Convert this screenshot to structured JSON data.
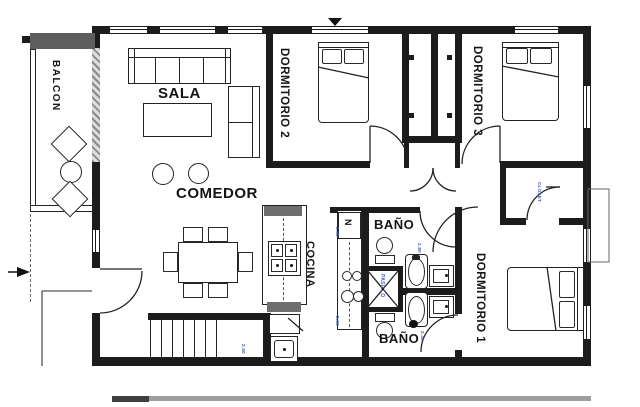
{
  "title": "Apartment floor plan",
  "rooms": {
    "balcony": {
      "label": "BALCON"
    },
    "living": {
      "label": "SALA"
    },
    "dining": {
      "label": "COMEDOR"
    },
    "kitchen": {
      "label": "COCINA"
    },
    "bedroom2": {
      "label": "DORMITORIO 2"
    },
    "bedroom3": {
      "label": "DORMITORIO 3"
    },
    "bedroom1": {
      "label": "DORMITORIO 1"
    },
    "bathroom_top": {
      "label": "BAÑO"
    },
    "bathroom_bottom": {
      "label": "BAÑO"
    },
    "shaft": {
      "label": "PASILLO"
    },
    "walkin_closet": {
      "label": "CLOSET"
    },
    "fridge": {
      "label": "N"
    }
  },
  "tiny_dimensions": {
    "d1": "2.80",
    "d2": "2.80",
    "d3": "2.80",
    "d4": "2.80",
    "d5": "2.40"
  },
  "colors": {
    "wall": "#1c1c1c",
    "balcony_band": "#5e5e5e",
    "counter_cap": "#6e6e6e",
    "dim_text": "#4a5fae"
  }
}
